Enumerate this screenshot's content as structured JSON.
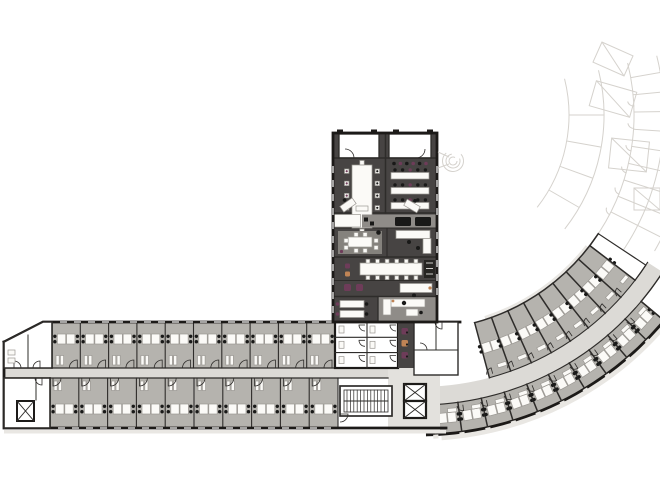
{
  "colors": {
    "background": "#ffffff",
    "wall": "#1c1a18",
    "thin_wall": "#2e2c2a",
    "wing_dark_floor": "#474443",
    "lounge_gray": "#8f8c88",
    "rug_gray": "#85827d",
    "office_floor": "#b5b3ae",
    "corridor_floor": "#dcdad6",
    "lobby_floor": "#e3e1dd",
    "plinth": "#e9e7e3",
    "ghost_line": "#d5d2cd",
    "furniture_white": "#fbfaf7",
    "furniture_stroke": "#9b9893",
    "chair_dark": "#191918",
    "accent_purple": "#6e3c59",
    "accent_orange": "#c08455"
  },
  "plan": {
    "arc": {
      "cx": 419,
      "cy": 115,
      "r_rooms_inner": 215,
      "r_corr_in": 272,
      "r_corr_out": 290,
      "r_outer": 320,
      "inner_rooms": {
        "start_deg": 75,
        "step_deg": 4.7,
        "count": 8
      },
      "outer_rooms": {
        "start_deg": 87,
        "step_deg": 4.7,
        "count": 10
      },
      "corridor_start_deg": 88.5,
      "corridor_end_deg": 32.8,
      "ghost_arcs": [
        [
          150,
          -14,
          38
        ],
        [
          185,
          -14,
          38
        ],
        [
          215,
          -14,
          36
        ],
        [
          245,
          -14,
          36
        ],
        [
          272,
          -14,
          30
        ],
        [
          290,
          -14,
          30
        ],
        [
          320,
          -14,
          33
        ]
      ],
      "ghost_line_step_deg": 4.6
    },
    "bottom_wing": {
      "corridor": {
        "x0": 4,
        "x1": 390,
        "y0": 368,
        "y1": 378
      },
      "top_row": {
        "x0": 52,
        "x1": 335,
        "y0": 322,
        "y1": 368,
        "rooms": 10
      },
      "bottom_row": {
        "x0": 50,
        "x1": 338,
        "y0": 378,
        "y1": 428,
        "rooms": 10
      }
    },
    "central_wing": {
      "x": 333,
      "y": 133,
      "w": 104,
      "h": 189
    },
    "conference_chairs_per_side": 5,
    "training_table_rows": 3,
    "wc_stall_rows": 3,
    "elevator_count_core_east": 2
  }
}
